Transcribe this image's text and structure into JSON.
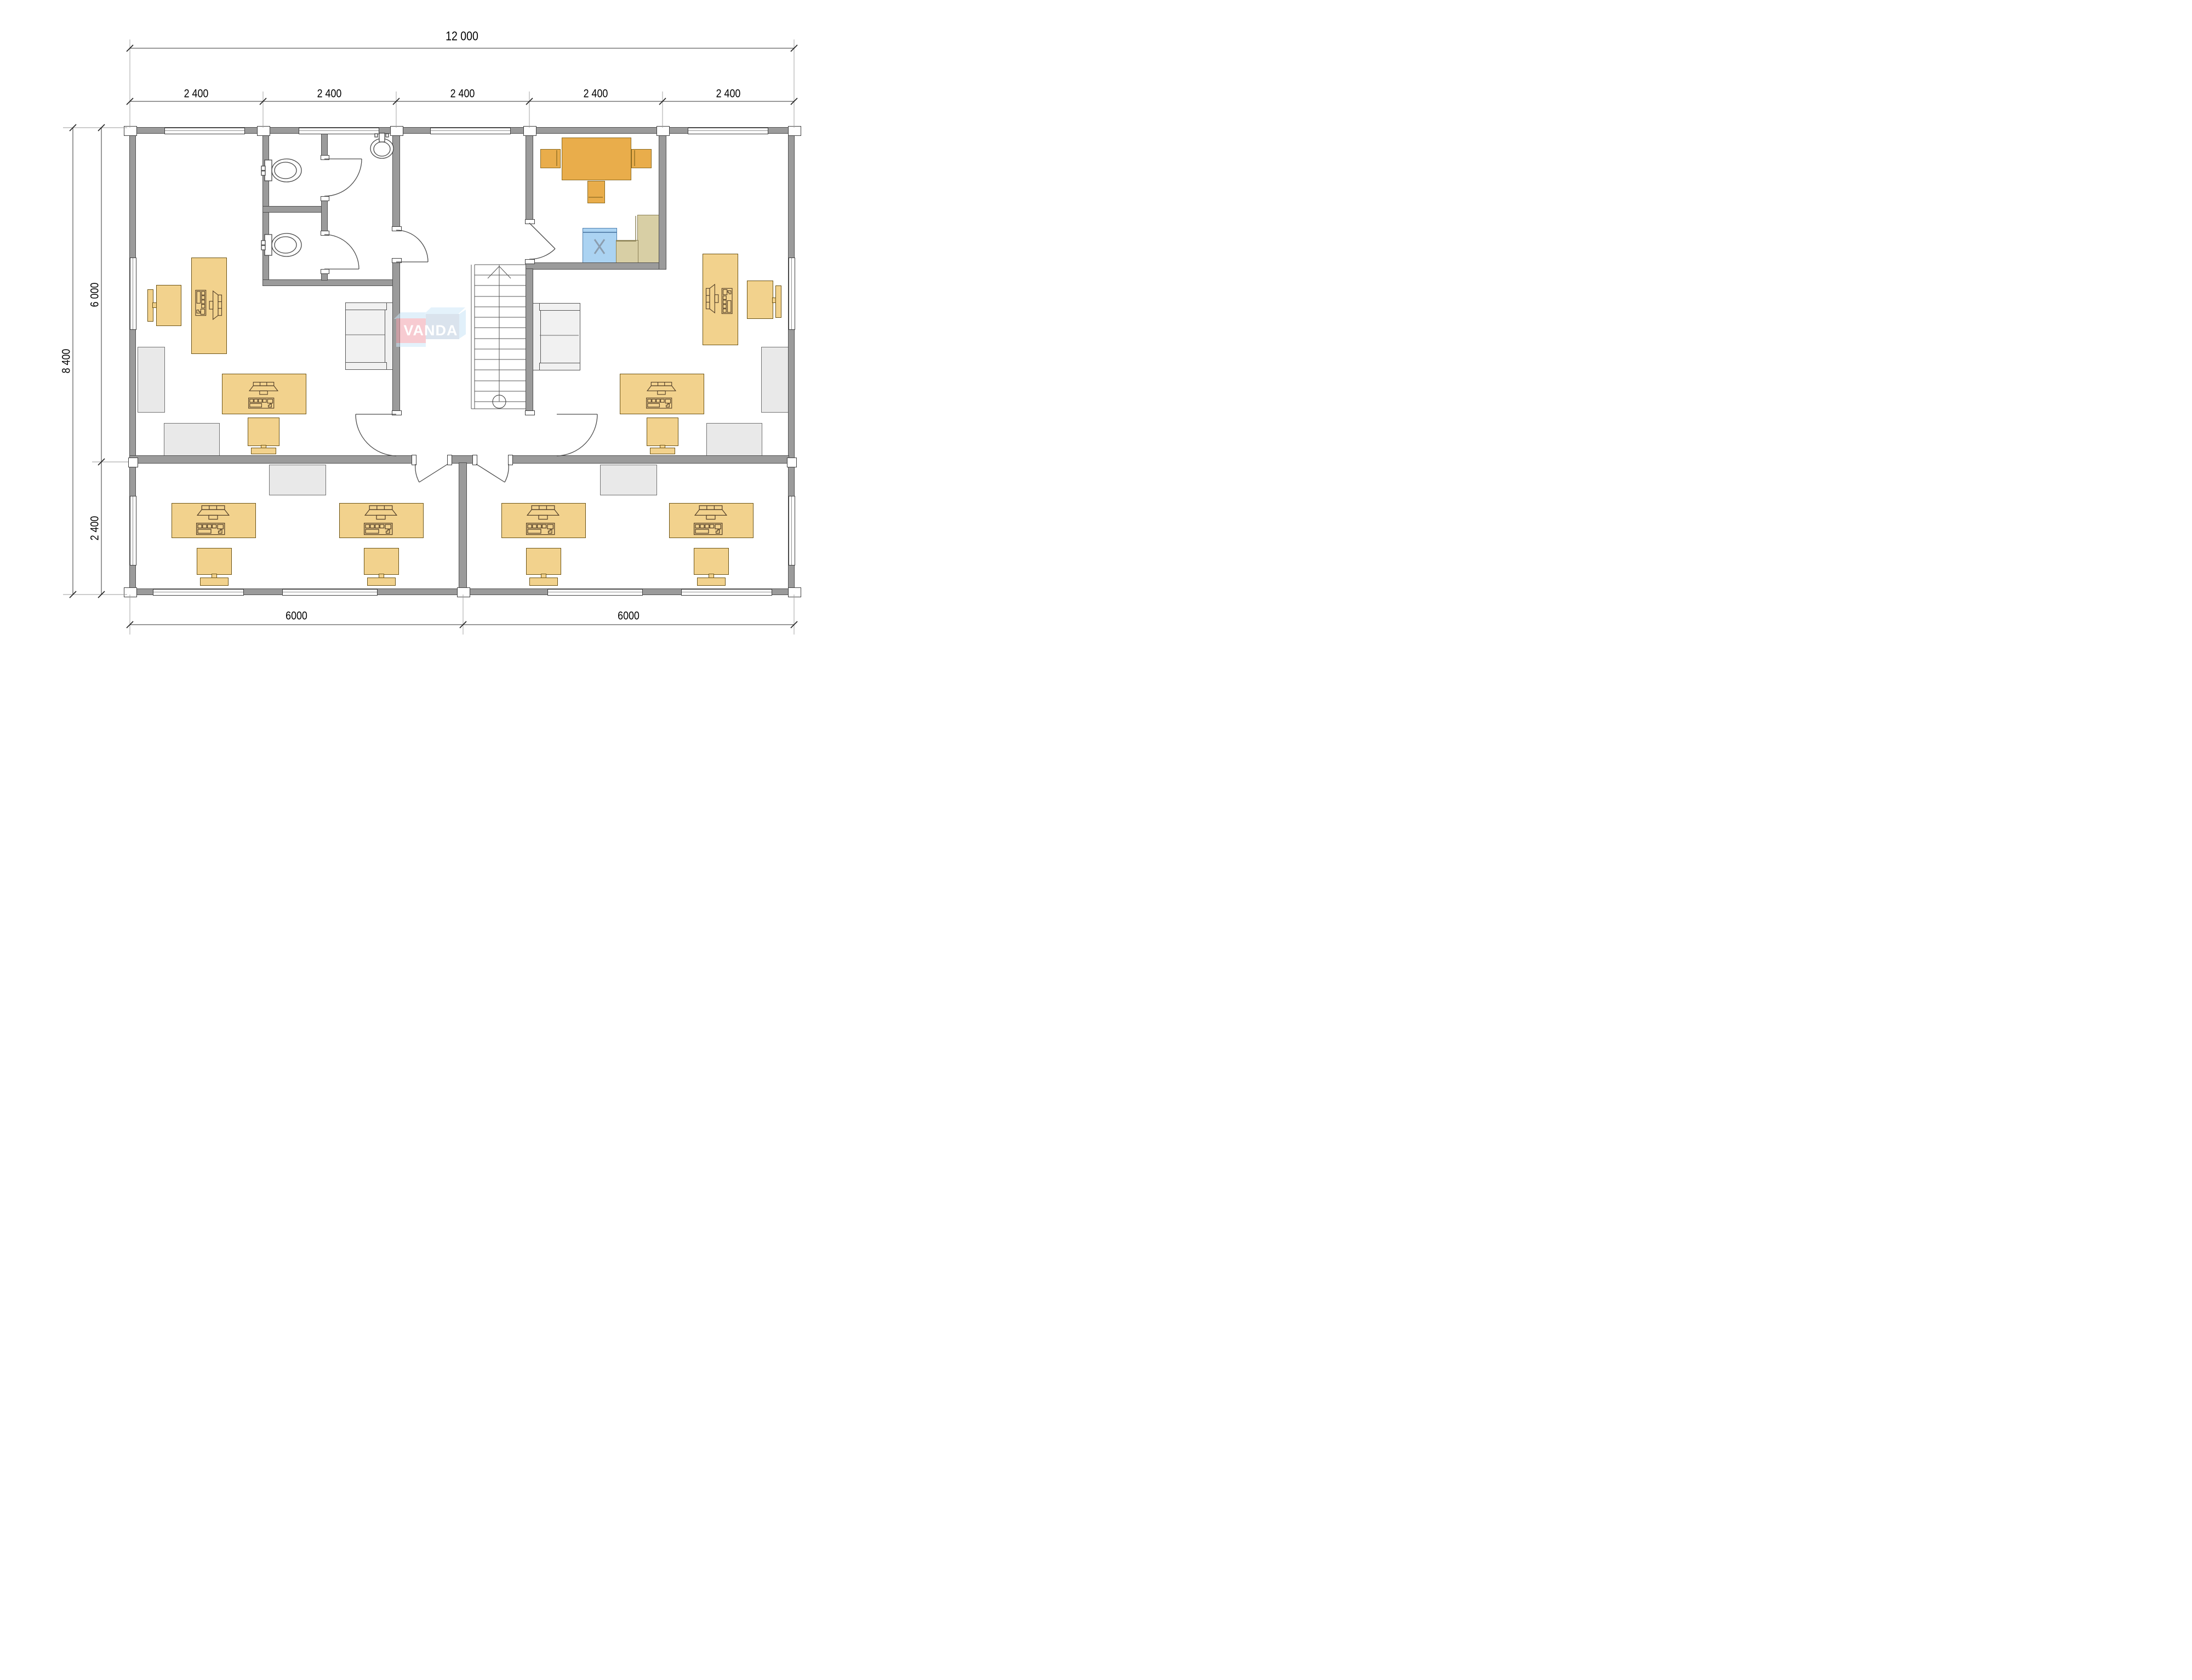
{
  "title": "Office floor plan drawing",
  "logo": {
    "text": "VANDA"
  },
  "dimensions": {
    "top_total": "12 000",
    "top_segments": [
      "2 400",
      "2 400",
      "2 400",
      "2 400",
      "2 400"
    ],
    "left_total": "8 400",
    "left_segments": [
      "6 000",
      "2 400"
    ],
    "bottom_segments": [
      "6000",
      "6000"
    ]
  },
  "annotations": {
    "appliance_mark": "X"
  },
  "colors": {
    "wall_fill": "#9b9b9b",
    "wall_outline": "#4f4f4f",
    "desk_amber": "#f2d28d",
    "kitchen_table_orange": "#e9ad4b",
    "appliance_blue": "#abd3f2",
    "counter_tan": "#d8cfa5",
    "gray_furniture": "#e9e9e9",
    "logo_pink": "#f2a2ad",
    "logo_blue": "#bccde0",
    "logo_bevel_light_blue": "#c9e5f6"
  },
  "icons": {
    "toilet": "svg-shape",
    "sink": "svg-shape",
    "stairs-up": "svg-shape",
    "door-swing": "svg-arc",
    "computer-workstation": "svg-shape",
    "dimension-tick": "svg-slash"
  }
}
